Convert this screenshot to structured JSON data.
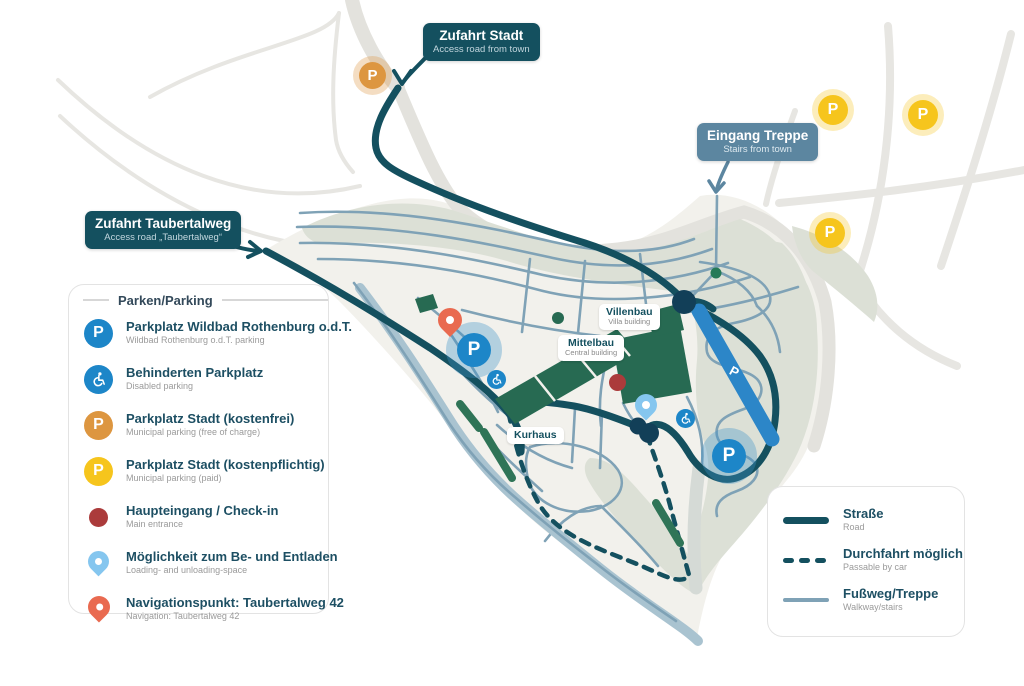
{
  "map": {
    "p_glyph": "P",
    "callouts": {
      "zufahrt_stadt": {
        "title": "Zufahrt Stadt",
        "subtitle": "Access road from town"
      },
      "zufahrt_taubertalweg": {
        "title": "Zufahrt Taubertalweg",
        "subtitle": "Access road „Taubertalweg“"
      },
      "eingang_treppe": {
        "title": "Eingang Treppe",
        "subtitle": "Stairs from town"
      }
    },
    "buildings": {
      "villenbau": {
        "title": "Villenbau",
        "subtitle": "Villa building"
      },
      "mittelbau": {
        "title": "Mittelbau",
        "subtitle": "Central building"
      },
      "kurhaus": {
        "title": "Kurhaus"
      }
    }
  },
  "parking_legend": {
    "title": "Parken/Parking",
    "items": [
      {
        "icon": "parking-blue",
        "title": "Parkplatz Wildbad Rothenburg o.d.T.",
        "subtitle": "Wildbad Rothenburg o.d.T. parking"
      },
      {
        "icon": "disabled",
        "title": "Behinderten Parkplatz",
        "subtitle": "Disabled parking"
      },
      {
        "icon": "parking-orange",
        "title": "Parkplatz Stadt (kostenfrei)",
        "subtitle": "Municipal parking (free of charge)"
      },
      {
        "icon": "parking-yellow",
        "title": "Parkplatz Stadt (kostenpflichtig)",
        "subtitle": "Municipal parking (paid)"
      },
      {
        "icon": "entrance-dot",
        "title": "Haupteingang / Check-in",
        "subtitle": "Main entrance"
      },
      {
        "icon": "loading-pin",
        "title": "Möglichkeit zum Be- und Entladen",
        "subtitle": "Loading- and unloading-space"
      },
      {
        "icon": "nav-pin",
        "title": "Navigationspunkt: Taubertalweg 42",
        "subtitle": "Navigation: Taubertalweg 42"
      }
    ]
  },
  "route_legend": {
    "items": [
      {
        "style": "solid",
        "title": "Straße",
        "subtitle": "Road"
      },
      {
        "style": "dashed",
        "title": "Durchfahrt möglich",
        "subtitle": "Passable by car"
      },
      {
        "style": "thin",
        "title": "Fußweg/Treppe",
        "subtitle": "Walkway/stairs"
      }
    ]
  },
  "colors": {
    "road_dark": "#14505f",
    "walkway_slate": "#7fa2b6",
    "shore": "#a9c3d0",
    "terrain_sage": "#dce0d6",
    "hill_cream": "#f2f1ec",
    "building_green": "#276a52",
    "parking_blue": "#1d86c8",
    "parking_strip_blue": "#2c86c8",
    "municipal_orange": "#dd9640",
    "municipal_yellow": "#f6c51d",
    "entrance_red": "#ab3b3b",
    "loading_pin_blue": "#85c6ef",
    "nav_pin_coral": "#e96a50",
    "callout_slate": "#5c86a0"
  }
}
